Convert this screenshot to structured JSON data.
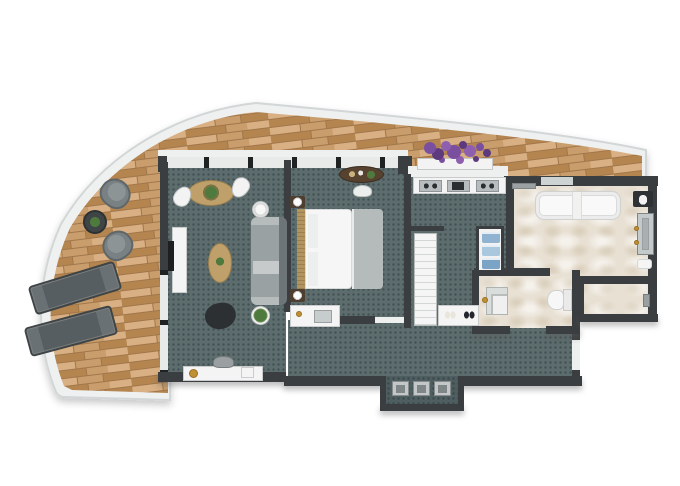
{
  "meta": {
    "type": "3D rendered top-down apartment floor plan",
    "visible_text": "none",
    "layout": "curved wrap-around balcony on left and top, living room, bedroom, kitchenette corridor, walk-in closet, hallway, bathroom suite on right"
  },
  "palette": {
    "background": "#ffffff",
    "wall": "#3b3e40",
    "glass-wall": "#e8eaea",
    "glass-post": "#1f2223",
    "railing": "#eff1f1",
    "railing-edge": "#d2d6d6",
    "wood-light": "#d8b083",
    "wood-mid": "#c99e6c",
    "wood-dark": "#b5854f",
    "wood-seam": "#a1764a",
    "carpet": "#5d6c6d",
    "carpet-dot": "#425154",
    "carpet-dark": "#4f5e60",
    "marble": "#e8e0d3",
    "furniture-white": "#f3f4f3",
    "sofa": "#9aa1a3",
    "sofa-back": "#6e7578",
    "sofa-arm": "#b6bbbc",
    "bed-blanket": "#b5babb",
    "headboard": "#b2945f",
    "nightstand": "#4e3e2f",
    "table-wood": "#bfa06a",
    "desk-wood": "#56422f",
    "armchair": "#2c3032",
    "tv-black": "#1d1f20",
    "chair-gray": "#7a8184",
    "chair-gray-dark": "#5f6668",
    "lounger-gray": "#575e61",
    "plant-green": "#4f7a3d",
    "flower-purple": "#7b4fa0",
    "flower-purple-dark": "#5d3a7e",
    "flower-purple-light": "#8e5fae",
    "gold": "#c09035",
    "towel-blue": "#8fb3d1",
    "towel-blue-mid": "#7ba3c6",
    "towel-blue-light": "#a9c7dd",
    "appliance-gray": "#b7bdbf",
    "appliance-dark": "#2b2e2f",
    "fixture-gray": "#aab0b1",
    "niche-gray": "#c3c7c8"
  },
  "rooms": [
    {
      "name": "balcony",
      "floor": "wood deck",
      "shape": "curved wrap-around"
    },
    {
      "name": "living-room",
      "floor": "teal dotted carpet"
    },
    {
      "name": "bedroom",
      "floor": "teal dotted carpet"
    },
    {
      "name": "kitchenette",
      "floor": "teal dotted carpet"
    },
    {
      "name": "walk-in-closet",
      "floor": "teal dotted carpet"
    },
    {
      "name": "hallway",
      "floor": "teal dotted carpet"
    },
    {
      "name": "main-bathroom",
      "floor": "marble"
    },
    {
      "name": "powder-room",
      "floor": "marble"
    },
    {
      "name": "shower-room",
      "floor": "marble"
    },
    {
      "name": "entry-niche",
      "floor": "teal dotted carpet"
    }
  ],
  "furniture": {
    "balcony": [
      "sun-lounger",
      "sun-lounger",
      "bistro-chair",
      "bistro-chair",
      "round-side-table-with-plant",
      "lavender-flower-planter"
    ],
    "living-room": [
      "oval-dining-table-with-plant",
      "dining-chair",
      "dining-chair",
      "round-side-table",
      "tv-console",
      "television",
      "oval-coffee-table-with-plant",
      "sofa",
      "armchair",
      "potted-plant",
      "writing-desk",
      "desk-chair",
      "gold-tray"
    ],
    "bedroom": [
      "double-bed",
      "headboard",
      "nightstand-with-lamp",
      "nightstand-with-lamp",
      "oval-desk-with-accessories",
      "desk-chair",
      "vanity-unit-with-sink"
    ],
    "kitchenette": [
      "counter-with-cooktop-sink-and-hob"
    ],
    "walk-in-closet": [
      "tall-shelving-unit",
      "shoe-shelf",
      "light-shoes",
      "dark-shoes",
      "linen-shelf-with-blue-towels"
    ],
    "main-bathroom": [
      "bathtub",
      "tub-shelf",
      "window",
      "towel-rack",
      "dark-washbasin-vanity",
      "shower-column",
      "bath-mat"
    ],
    "powder-room": [
      "washbasin-vanity",
      "toilet"
    ],
    "shower-room": [
      "shower-fixture"
    ],
    "entry-niche": [
      "storage-box",
      "storage-box",
      "storage-box"
    ]
  }
}
